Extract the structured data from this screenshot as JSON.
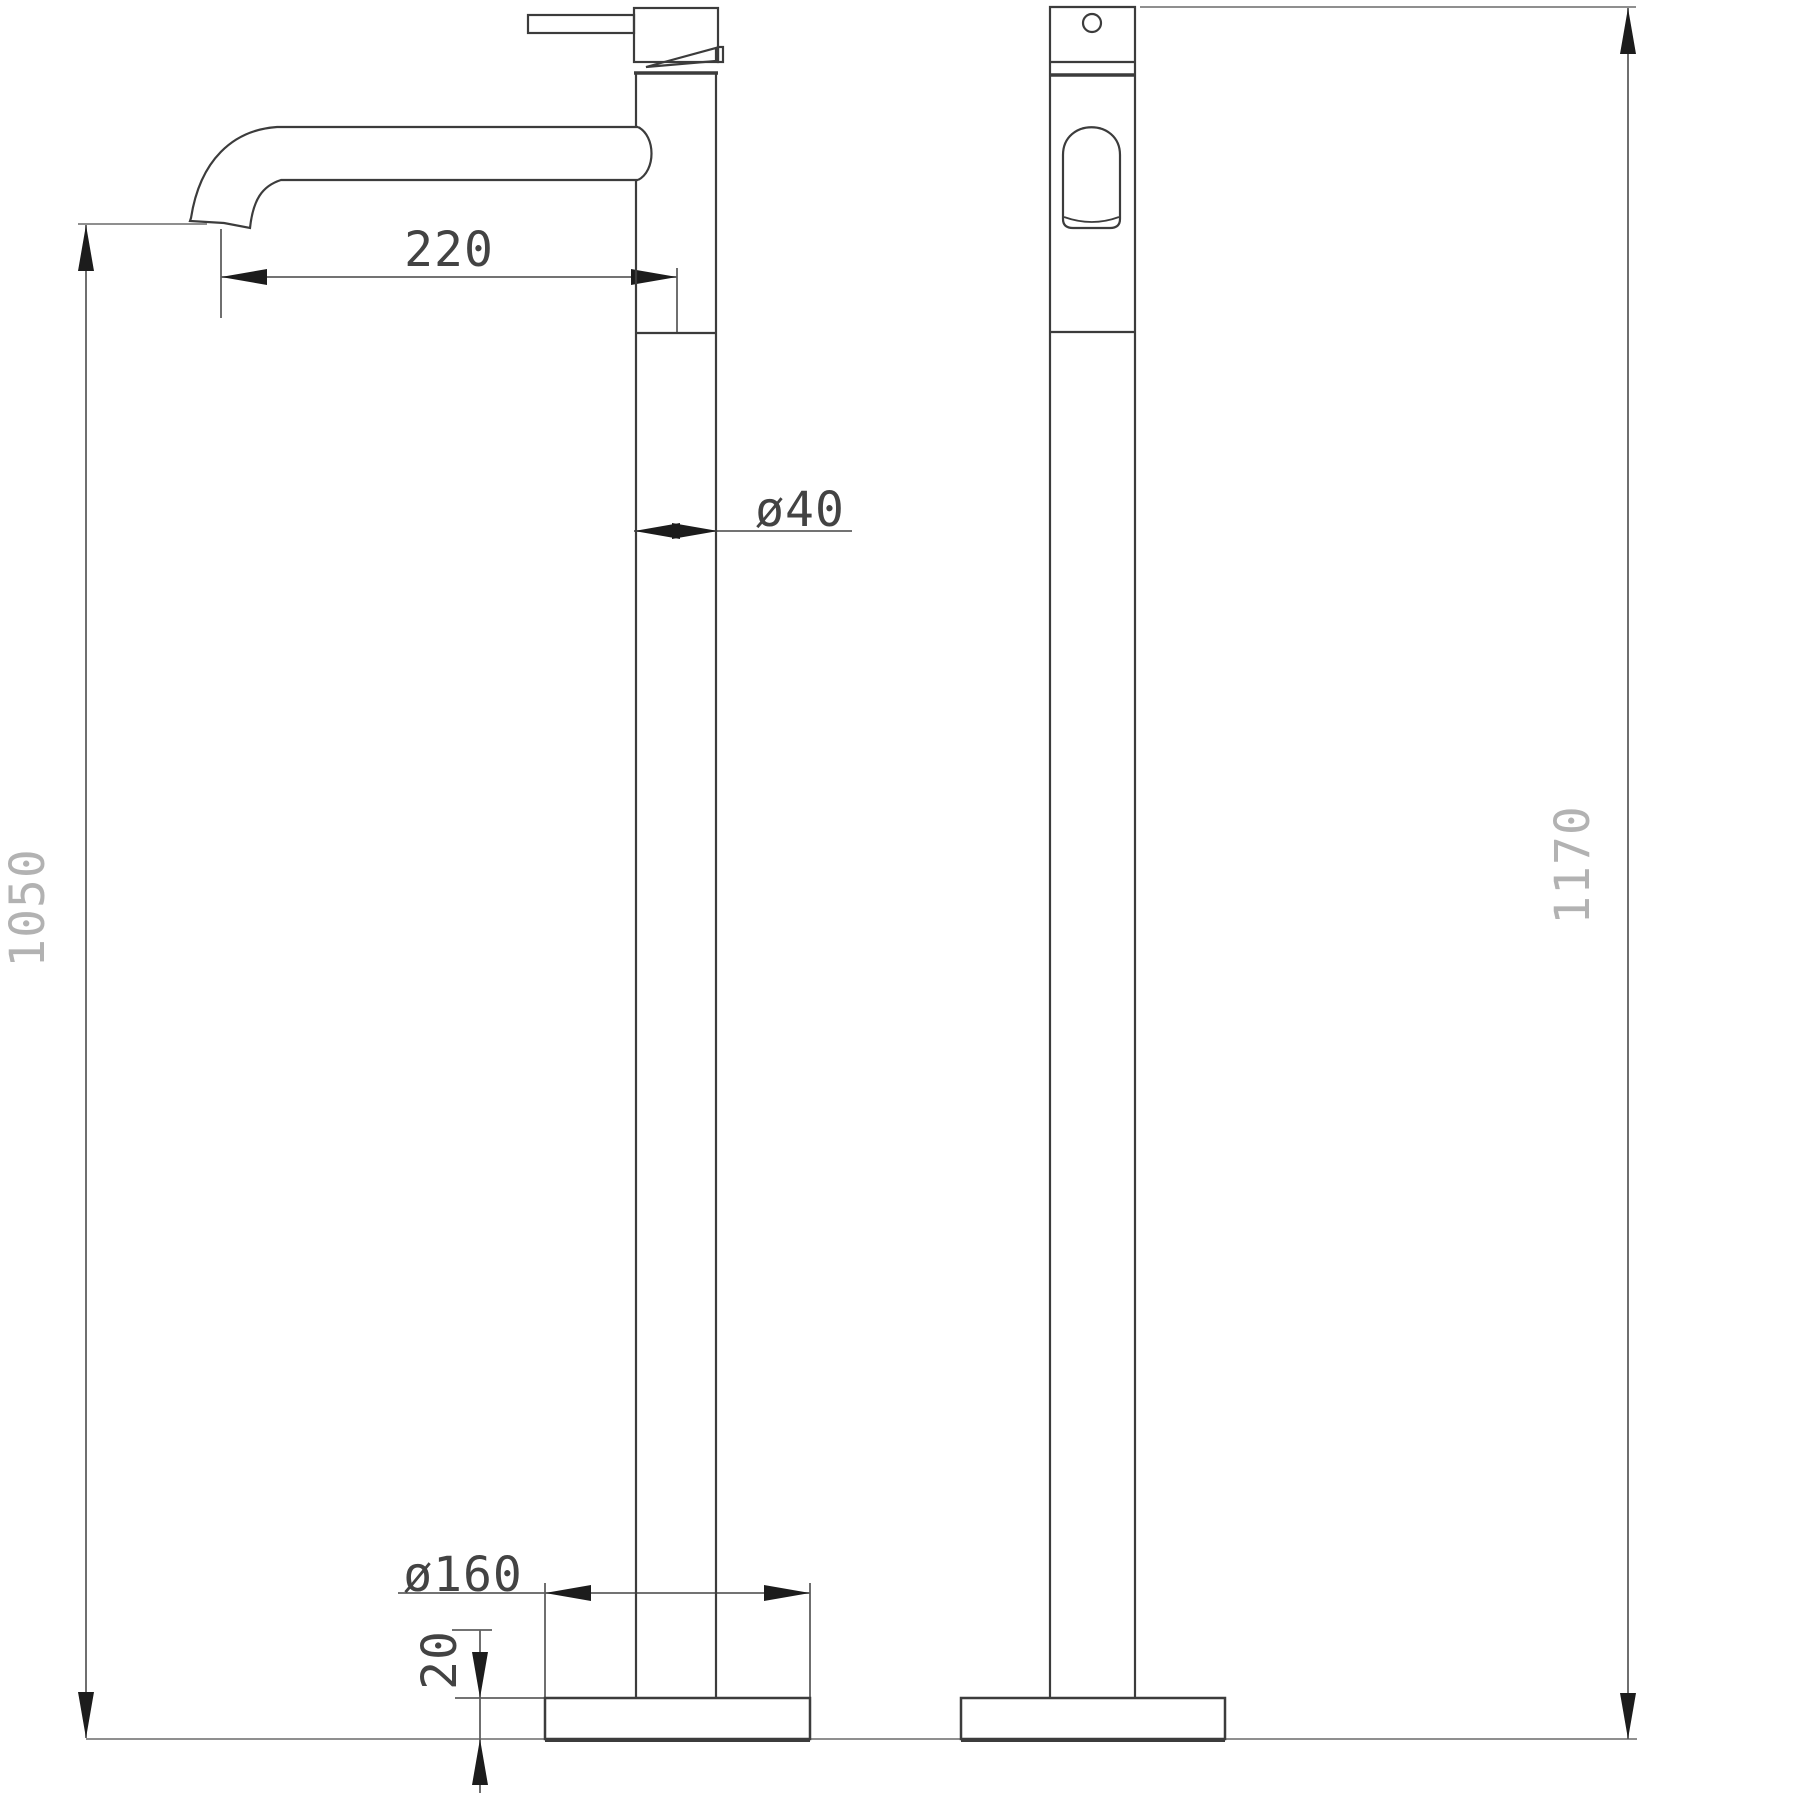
{
  "drawing": {
    "type": "technical-dimension-drawing",
    "subject": "freestanding-basin-mixer-tap-two-views",
    "colors": {
      "background": "#ffffff",
      "object_line": "#3c3c3c",
      "dim_line": "#5f5f5f",
      "ext_line": "#8f8f8f",
      "arrow": "#1c1c1c",
      "label_dark": "#434343",
      "label_gray": "#b2b2b2"
    },
    "dimensions": {
      "spout_reach": {
        "label": "220"
      },
      "column_diameter": {
        "label": "ø40"
      },
      "spout_height": {
        "label": "1050"
      },
      "base_diameter": {
        "label": "ø160"
      },
      "base_thickness": {
        "label": "20"
      },
      "total_height": {
        "label": "1170"
      }
    }
  }
}
